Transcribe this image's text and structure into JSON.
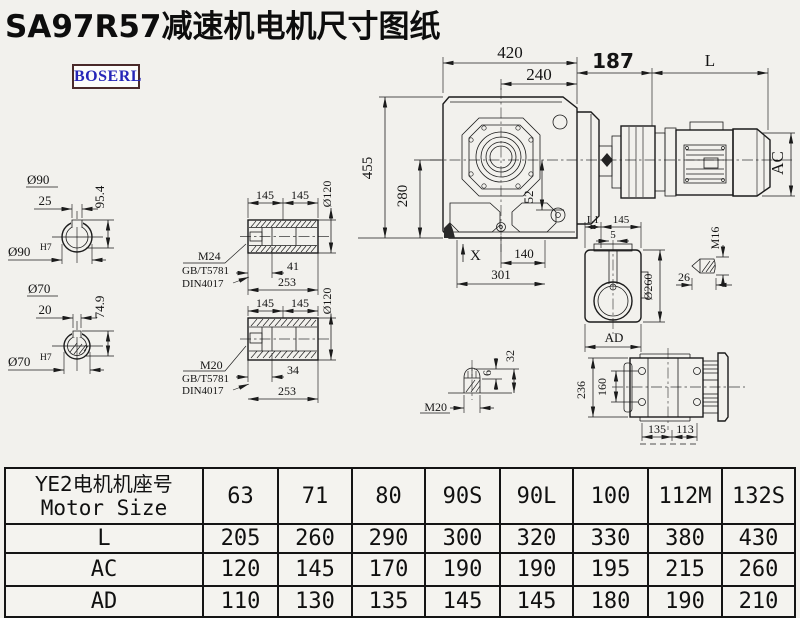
{
  "page": {
    "title": "SA97R57减速机电机尺寸图纸",
    "logo": "BOSERL"
  },
  "front_view": {
    "width": "420",
    "center_width": "240",
    "height": "455",
    "center_height": "280",
    "offset": "52",
    "x_mark": "X",
    "hole_span": "140",
    "base_span": "301"
  },
  "motor": {
    "adapter_len": "187",
    "motor_len": "L",
    "motor_dia": "AC"
  },
  "output_shaft_90": {
    "dia": "Ø90",
    "key_len": "25",
    "key_height": "95.4",
    "bore": "Ø90",
    "fit": "H7"
  },
  "output_shaft_70": {
    "dia": "Ø70",
    "key_len": "20",
    "key_height": "74.9",
    "bore": "Ø70",
    "fit": "H7"
  },
  "hollow_shaft_top": {
    "seg1": "145",
    "seg2": "145",
    "dia": "Ø120",
    "bolt_len": "41",
    "total_len": "253",
    "thread": "M24",
    "std1": "GB/T5781",
    "std2": "DIN4017"
  },
  "hollow_shaft_bottom": {
    "seg1": "145",
    "seg2": "145",
    "dia": "Ø120",
    "bolt_len": "34",
    "total_len": "253",
    "thread": "M20",
    "std1": "GB/T5781",
    "std2": "DIN4017"
  },
  "side_view": {
    "l1": "L1",
    "flange": "145",
    "offset": "5",
    "dia": "Ø260",
    "width": "AD"
  },
  "stud_m16": {
    "thread": "M16",
    "length": "26"
  },
  "stud_m20": {
    "thread": "M20",
    "tip": "6",
    "length": "32"
  },
  "rear_view": {
    "height": "236",
    "bolt_span": "160",
    "foot1": "135",
    "foot2": "113"
  },
  "table": {
    "header_cn": "YE2电机机座号",
    "header_en": "Motor Size",
    "sizes": [
      "63",
      "71",
      "80",
      "90S",
      "90L",
      "100",
      "112M",
      "132S"
    ],
    "rows": [
      {
        "label": "L",
        "values": [
          "205",
          "260",
          "290",
          "300",
          "320",
          "330",
          "380",
          "430"
        ]
      },
      {
        "label": "AC",
        "values": [
          "120",
          "145",
          "170",
          "190",
          "190",
          "195",
          "215",
          "260"
        ]
      },
      {
        "label": "AD",
        "values": [
          "110",
          "130",
          "135",
          "145",
          "145",
          "180",
          "190",
          "210"
        ]
      }
    ]
  }
}
